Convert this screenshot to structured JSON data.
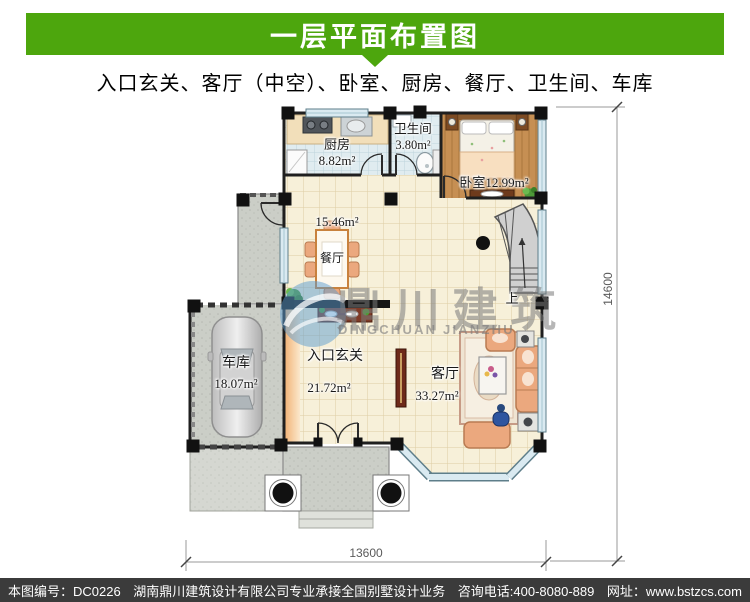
{
  "banner": {
    "title": "一层平面布置图"
  },
  "subtitle": "入口玄关、客厅（中空）、卧室、厨房、餐厅、卫生间、车库",
  "plan": {
    "rooms": {
      "kitchen": {
        "name": "厨房",
        "area": "8.82m²"
      },
      "bath": {
        "name": "卫生间",
        "area": "3.80m²"
      },
      "bedroom": {
        "name": "卧室",
        "area": "12.99m²"
      },
      "dining": {
        "name": "餐厅",
        "area": "15.46m²"
      },
      "entry": {
        "name": "入口玄关",
        "area": "21.72m²"
      },
      "living": {
        "name": "客厅",
        "area": "33.27m²"
      },
      "garage": {
        "name": "车库",
        "area": "18.07m²"
      }
    },
    "stairs": {
      "up_label": "上"
    },
    "watermark": {
      "cn": "鼎川建筑",
      "en": "DINGCHUAN JIANZHU"
    },
    "dimensions": {
      "right": "14600",
      "bottom": "13600"
    }
  },
  "colors": {
    "accent_green": "#4DA60D",
    "footer_bg": "#3B3B3B"
  },
  "footer": {
    "code": "本图编号：DC0226",
    "company": "湖南鼎川建筑设计有限公司专业承接全国别墅设计业务",
    "phone": "咨询电话:400-8080-889",
    "site": "网址：www.bstzcs.com"
  }
}
